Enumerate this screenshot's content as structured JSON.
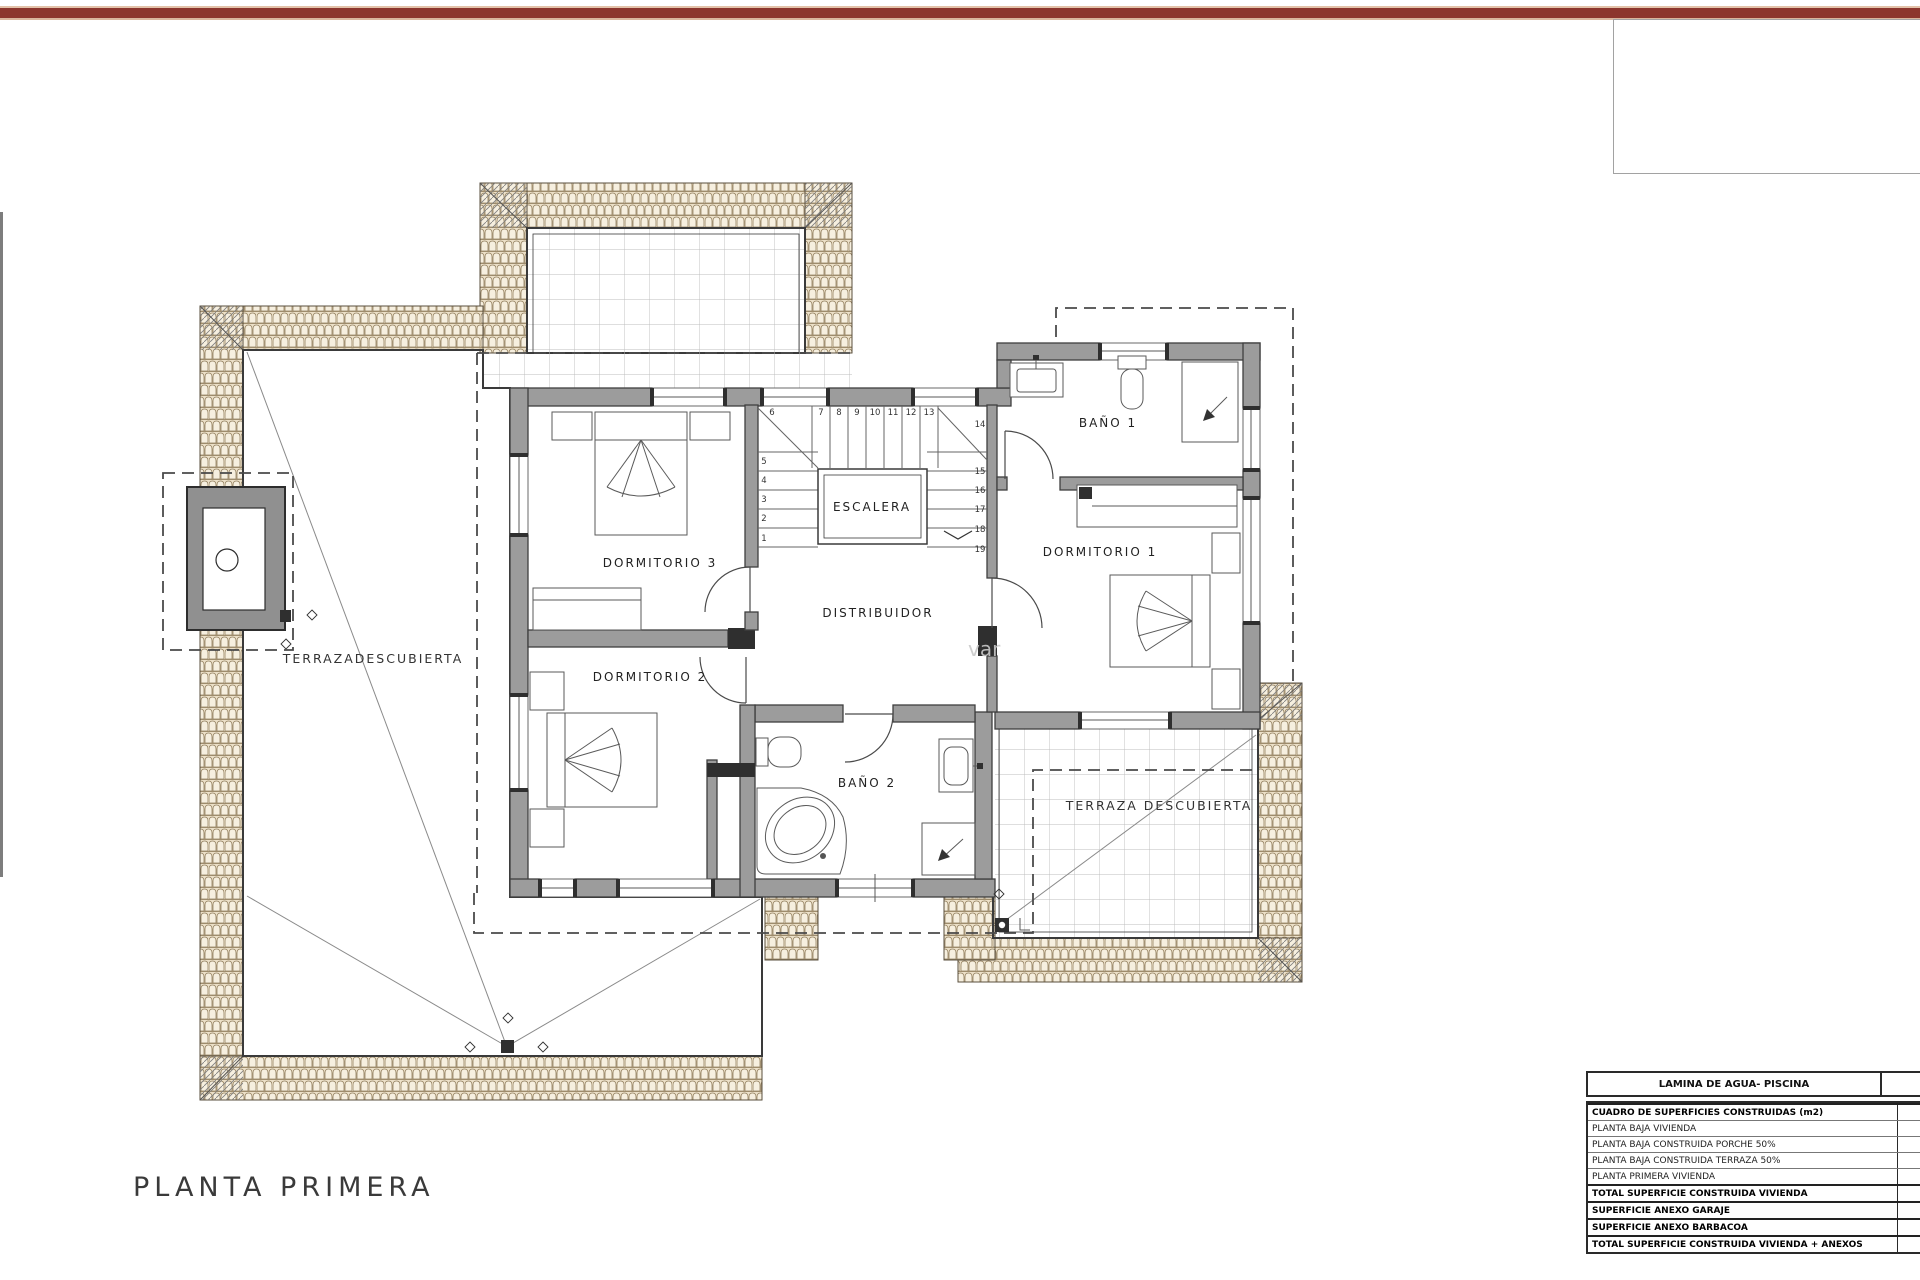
{
  "page": {
    "top_bar_color": "#8c362d",
    "title": "PLANTA PRIMERA",
    "watermark": "var"
  },
  "plan": {
    "rooms": {
      "dormitorio1": "DORMITORIO 1",
      "dormitorio2": "DORMITORIO 2",
      "dormitorio3": "DORMITORIO 3",
      "bano1": "BAÑO 1",
      "bano2": "BAÑO 2",
      "escalera": "ESCALERA",
      "distribuidor": "DISTRIBUIDOR",
      "terraza_izquierda": "TERRAZADESCUBIERTA",
      "terraza_derecha": "TERRAZA DESCUBIERTA"
    },
    "stairs": {
      "top": [
        "6",
        "7",
        "8",
        "9",
        "10",
        "11",
        "12",
        "13"
      ],
      "left": [
        "5",
        "4",
        "3",
        "2",
        "1"
      ],
      "right": [
        "14",
        "15",
        "16",
        "17",
        "18",
        "19"
      ]
    }
  },
  "summary_table": {
    "pool_row_label": "LAMINA DE AGUA- PISCINA",
    "rows": [
      {
        "label": "CUADRO DE SUPERFICIES CONSTRUIDAS (m2)"
      },
      {
        "label": "PLANTA BAJA VIVIENDA"
      },
      {
        "label": "PLANTA BAJA CONSTRUIDA PORCHE 50%"
      },
      {
        "label": "PLANTA BAJA CONSTRUIDA TERRAZA 50%"
      },
      {
        "label": "PLANTA PRIMERA VIVIENDA"
      },
      {
        "label": "TOTAL SUPERFICIE CONSTRUIDA VIVIENDA"
      },
      {
        "label": "SUPERFICIE ANEXO GARAJE"
      },
      {
        "label": "SUPERFICIE ANEXO BARBACOA"
      },
      {
        "label": "TOTAL SUPERFICIE CONSTRUIDA VIVIENDA + ANEXOS"
      }
    ]
  }
}
